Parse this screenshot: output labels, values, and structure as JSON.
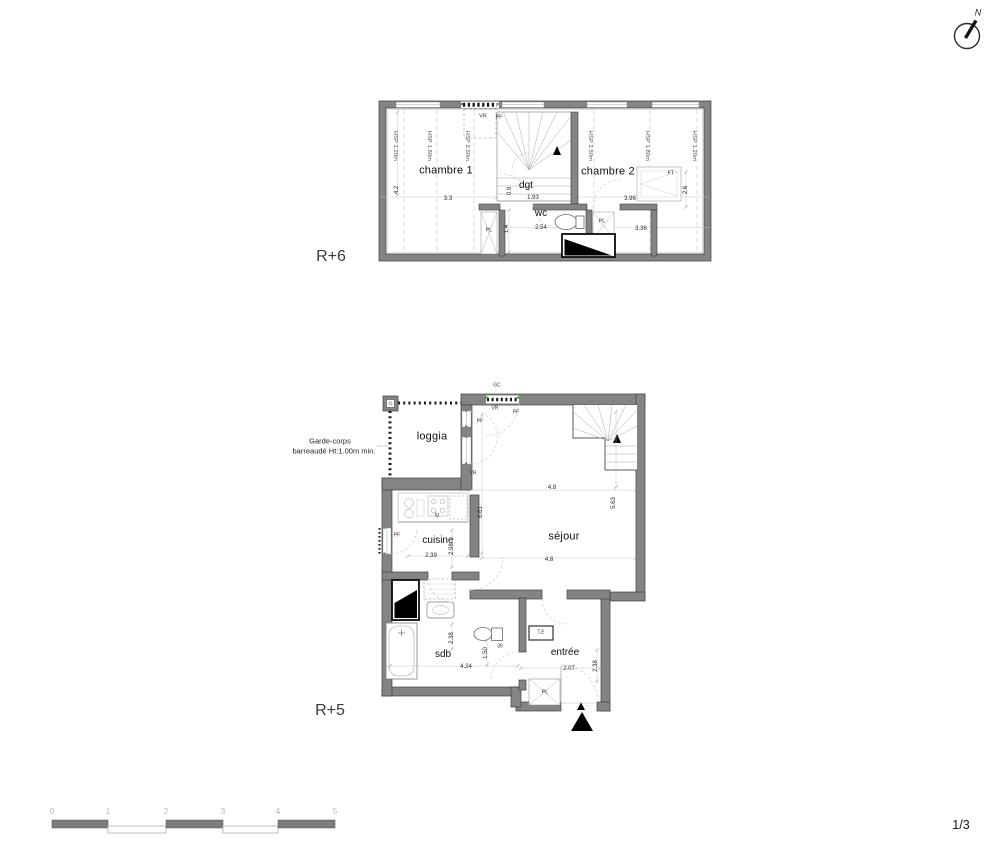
{
  "sheet": {
    "page_indicator": "1/3"
  },
  "compass": {
    "north_label": "N"
  },
  "scale_bar": {
    "ticks": [
      "0",
      "1",
      "2",
      "3",
      "4",
      "5"
    ]
  },
  "floors": {
    "r6": {
      "label": "R+6"
    },
    "r5": {
      "label": "R+5",
      "note_line1": "Garde-corps",
      "note_line2": "barreaudé Ht:1.00m min."
    }
  },
  "colors": {
    "wall": "#848484",
    "window_marker_green": "#3f9b3f",
    "fixture_black": "#000000"
  },
  "annotations": [
    {
      "name": "hsp-note-r6-left-1",
      "text": "HSP 1.20m",
      "x": 394,
      "y": 146,
      "rot": 90,
      "cls": "hsp"
    },
    {
      "name": "hsp-note-r6-left-2",
      "text": "HSP 1.80m",
      "x": 428,
      "y": 146,
      "rot": 90,
      "cls": "hsp"
    },
    {
      "name": "hsp-note-r6-left-3",
      "text": "HSP 2.50m",
      "x": 466,
      "y": 146,
      "rot": 90,
      "cls": "hsp"
    },
    {
      "name": "hsp-note-r6-right-1",
      "text": "HSP 2.50m",
      "x": 589,
      "y": 146,
      "rot": 90,
      "cls": "hsp"
    },
    {
      "name": "hsp-note-r6-right-2",
      "text": "HSP 1.80m",
      "x": 646,
      "y": 146,
      "rot": 90,
      "cls": "hsp"
    },
    {
      "name": "hsp-note-r6-right-3",
      "text": "HSP 1.20m",
      "x": 693,
      "y": 146,
      "rot": 90,
      "cls": "hsp"
    },
    {
      "name": "room-label-chambre-1",
      "text": "chambre 1",
      "x": 446,
      "y": 171,
      "cls": "room"
    },
    {
      "name": "room-label-chambre-2",
      "text": "chambre 2",
      "x": 608,
      "y": 172,
      "cls": "room"
    },
    {
      "name": "room-label-dgt",
      "text": "dgt",
      "x": 526,
      "y": 186,
      "cls": "room2"
    },
    {
      "name": "room-label-wc",
      "text": "wc",
      "x": 541,
      "y": 214,
      "cls": "room2"
    },
    {
      "name": "window-tag-vr-r6",
      "text": "VR",
      "x": 483,
      "y": 117,
      "cls": "tiny"
    },
    {
      "name": "window-tag-pf-r6",
      "text": "PF",
      "x": 499,
      "y": 118,
      "cls": "tiny"
    },
    {
      "name": "window-tag-ft",
      "text": "FT",
      "x": 671,
      "y": 174,
      "cls": "tiny"
    },
    {
      "name": "closet-tag-pl-r6-left",
      "text": "PL",
      "x": 489,
      "y": 231,
      "cls": "tiny"
    },
    {
      "name": "closet-tag-pl-r6-right",
      "text": "PL",
      "x": 602,
      "y": 222,
      "cls": "tiny"
    },
    {
      "name": "dim-chambre1-width",
      "text": "3.3",
      "x": 448,
      "y": 199,
      "cls": "dim"
    },
    {
      "name": "dim-chambre1-depth",
      "text": "4.2",
      "x": 397,
      "y": 190,
      "rot": -90,
      "cls": "dim"
    },
    {
      "name": "dim-dgt-width",
      "text": "1.93",
      "x": 533,
      "y": 198,
      "cls": "dim"
    },
    {
      "name": "dim-dgt-side",
      "text": "0.9",
      "x": 510,
      "y": 191,
      "rot": -90,
      "cls": "dim"
    },
    {
      "name": "dim-chambre2-width",
      "text": "3.96",
      "x": 630,
      "y": 199,
      "cls": "dim"
    },
    {
      "name": "dim-wc-width",
      "text": "2.54",
      "x": 541,
      "y": 228,
      "cls": "dim"
    },
    {
      "name": "dim-r6-right-width",
      "text": "3.36",
      "x": 641,
      "y": 229,
      "cls": "dim"
    },
    {
      "name": "dim-wc-depth",
      "text": "1.4",
      "x": 507,
      "y": 229,
      "rot": -90,
      "cls": "dim"
    },
    {
      "name": "dim-ft-side",
      "text": "2.6",
      "x": 686,
      "y": 190,
      "rot": -90,
      "cls": "dim"
    },
    {
      "name": "room-label-loggia",
      "text": "loggia",
      "x": 432,
      "y": 437,
      "cls": "room"
    },
    {
      "name": "tag-gc",
      "text": "GC",
      "x": 497,
      "y": 386,
      "cls": "micro"
    },
    {
      "name": "window-tag-vr-r5-top",
      "text": "VR",
      "x": 495,
      "y": 409,
      "cls": "micro"
    },
    {
      "name": "window-tag-pf-r5-top",
      "text": "PF",
      "x": 516,
      "y": 413,
      "cls": "micro"
    },
    {
      "name": "window-tag-pf-loggia-1",
      "text": "PF",
      "x": 480,
      "y": 422,
      "cls": "micro"
    },
    {
      "name": "window-tag-vr-loggia-2",
      "text": "VR",
      "x": 473,
      "y": 474,
      "cls": "micro"
    },
    {
      "name": "window-tag-pf-cuisine",
      "text": "PF",
      "x": 397,
      "y": 536,
      "cls": "micro"
    },
    {
      "name": "room-label-cuisine",
      "text": "cuisine",
      "x": 438,
      "y": 541,
      "cls": "room2"
    },
    {
      "name": "dim-cuisine-width",
      "text": "2.39",
      "x": 431,
      "y": 556,
      "cls": "dim"
    },
    {
      "name": "dim-cuisine-depth",
      "text": "2.98",
      "x": 452,
      "y": 549,
      "rot": -90,
      "cls": "dim"
    },
    {
      "name": "tag-fridge",
      "text": "fg",
      "x": 437,
      "y": 516,
      "cls": "micro"
    },
    {
      "name": "room-label-sejour",
      "text": "séjour",
      "x": 564,
      "y": 537,
      "cls": "room"
    },
    {
      "name": "dim-sejour-width-1",
      "text": "4.8",
      "x": 552,
      "y": 488,
      "cls": "dim"
    },
    {
      "name": "dim-sejour-width-2",
      "text": "4.8",
      "x": 549,
      "y": 560,
      "cls": "dim"
    },
    {
      "name": "dim-sejour-depth-left",
      "text": "6.61",
      "x": 481,
      "y": 512,
      "rot": -90,
      "cls": "dim"
    },
    {
      "name": "dim-sejour-depth-right",
      "text": "5.63",
      "x": 614,
      "y": 503,
      "rot": -90,
      "cls": "dim"
    },
    {
      "name": "room-label-sdb",
      "text": "sdb",
      "x": 443,
      "y": 655,
      "cls": "room2"
    },
    {
      "name": "dim-sdb-width",
      "text": "4.24",
      "x": 466,
      "y": 667,
      "cls": "dim"
    },
    {
      "name": "dim-sdb-depth",
      "text": "2.38",
      "x": 452,
      "y": 638,
      "rot": -90,
      "cls": "dim"
    },
    {
      "name": "dim-sdb-right",
      "text": "1.50",
      "x": 486,
      "y": 653,
      "rot": -90,
      "cls": "dim"
    },
    {
      "name": "dim-basin",
      "text": "36",
      "x": 500,
      "y": 647,
      "cls": "micro"
    },
    {
      "name": "tag-electrical-panel",
      "text": "T.E",
      "x": 541,
      "y": 633,
      "cls": "micro"
    },
    {
      "name": "room-label-entree",
      "text": "entrée",
      "x": 565,
      "y": 653,
      "cls": "room2"
    },
    {
      "name": "dim-entree-width",
      "text": "2.07",
      "x": 569,
      "y": 669,
      "cls": "dim"
    },
    {
      "name": "dim-entree-depth",
      "text": "2.38",
      "x": 596,
      "y": 666,
      "rot": -90,
      "cls": "dim"
    },
    {
      "name": "closet-tag-pl-entree",
      "text": "PL",
      "x": 545,
      "y": 693,
      "cls": "tiny"
    }
  ],
  "scale_tick_x": [
    52,
    108,
    166,
    223,
    278,
    335
  ],
  "scale_tick_y": 812
}
